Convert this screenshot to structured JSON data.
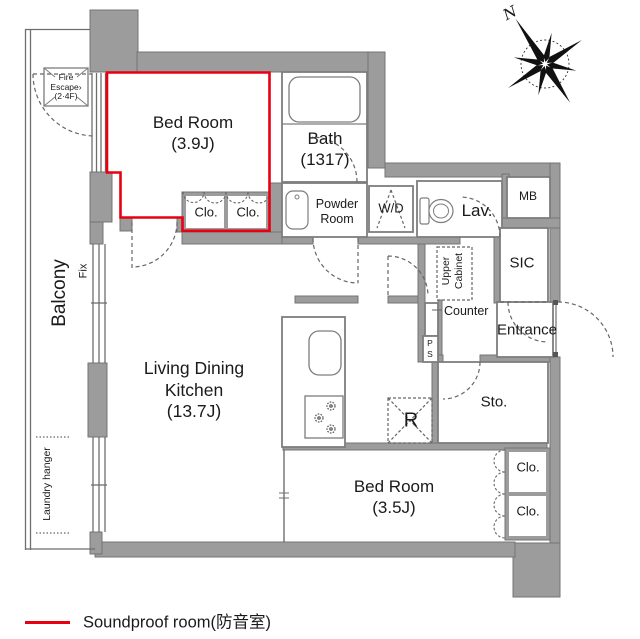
{
  "colors": {
    "wall": "#9c9c9c",
    "soundproof_outline": "#e60012",
    "linework": "#6e6e6e"
  },
  "compass": {
    "north": "N"
  },
  "rooms": {
    "bedroom_a": {
      "name": "Bed Room",
      "size": "(3.9J)"
    },
    "bath": {
      "name": "Bath",
      "size": "(1317)"
    },
    "closet": {
      "label": "Clo."
    },
    "powder_room": {
      "line1": "Powder",
      "line2": "Room"
    },
    "washer_dryer": {
      "label": "W/D"
    },
    "lavatory": {
      "label": "Lav."
    },
    "meter_box": {
      "label": "MB"
    },
    "shoe_closet": {
      "label": "SIC"
    },
    "upper_cabinet": {
      "line1": "Upper",
      "line2": "Cabinet"
    },
    "counter": {
      "label": "Counter"
    },
    "entrance": {
      "label": "Entrance"
    },
    "pipe_shaft": {
      "line1": "P",
      "line2": "S"
    },
    "storage": {
      "label": "Sto."
    },
    "refrigerator": {
      "label": "R"
    },
    "ldk": {
      "line1": "Living Dining",
      "line2": "Kitchen",
      "size": "(13.7J)"
    },
    "bedroom_b": {
      "name": "Bed Room",
      "size": "(3.5J)"
    },
    "balcony": {
      "label": "Balcony"
    },
    "fix_window": {
      "label": "Fix"
    },
    "laundry_hanger": {
      "label": "Laundry hanger"
    },
    "fire_escape": {
      "line1": "Fire",
      "line2": "Escape›",
      "line3": "(2·4F)"
    }
  },
  "legend": {
    "label": "Soundproof room(防音室)"
  }
}
